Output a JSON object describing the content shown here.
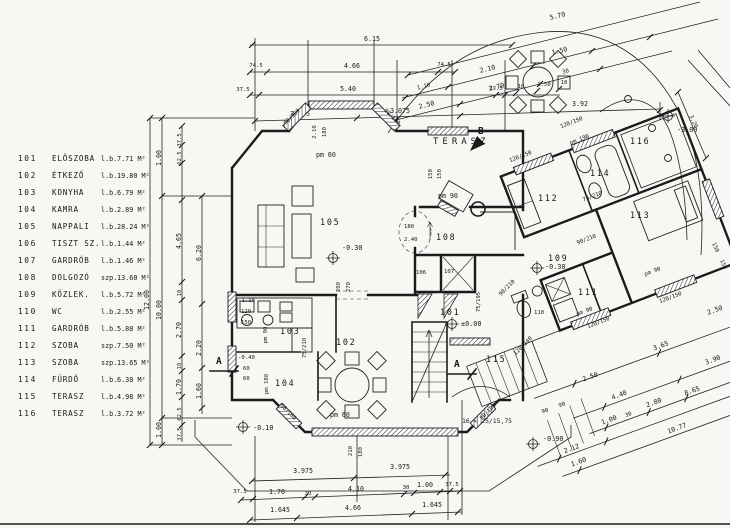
{
  "legend": {
    "rows": [
      {
        "n": "101",
        "m": "ELŐSZOBA",
        "t": "l.b.",
        "a": "7.71 M²"
      },
      {
        "n": "102",
        "m": "ÉTKEZŐ",
        "t": "l.b.",
        "a": "19.80 M²"
      },
      {
        "n": "103",
        "m": "KONYHA",
        "t": "l.b.",
        "a": "6.79 M²"
      },
      {
        "n": "104",
        "m": "KAMRA",
        "t": "l.b.",
        "a": "2.89 M²"
      },
      {
        "n": "105",
        "m": "NAPPALI",
        "t": "l.b.",
        "a": "28.24 M²"
      },
      {
        "n": "106",
        "m": "TISZT SZ.",
        "t": "l.b.",
        "a": "1.44 M²"
      },
      {
        "n": "107",
        "m": "GARDRÓB",
        "t": "l.b.",
        "a": "1.46 M²"
      },
      {
        "n": "108",
        "m": "DOLGOZÓ",
        "t": "szp.",
        "a": "13.60 M²"
      },
      {
        "n": "109",
        "m": "KÖZLEK.",
        "t": "l.b.",
        "a": "5.72 M²"
      },
      {
        "n": "110",
        "m": "WC",
        "t": "l.b.",
        "a": "2.55 M²"
      },
      {
        "n": "111",
        "m": "GARDRÓB",
        "t": "l.b.",
        "a": "5.88 M²"
      },
      {
        "n": "112",
        "m": "SZOBA",
        "t": "szp.",
        "a": "7.50 M²"
      },
      {
        "n": "113",
        "m": "SZOBA",
        "t": "szp.",
        "a": "13.65 M²"
      },
      {
        "n": "114",
        "m": "FÜRDŐ",
        "t": "l.b.",
        "a": "6.30 M²"
      },
      {
        "n": "115",
        "m": "TERASZ",
        "t": "l.b.",
        "a": "4.98 M²"
      },
      {
        "n": "116",
        "m": "TERASZ",
        "t": "l.b.",
        "a": "3.72 M²"
      }
    ]
  },
  "rooms": {
    "r101": "101",
    "r102": "102",
    "r103": "103",
    "r104": "104",
    "r105": "105",
    "r106": "106",
    "r107": "107",
    "r108": "108",
    "r109": "109",
    "r110": "110",
    "r111": "111",
    "r112": "112",
    "r113": "113",
    "r114": "114",
    "r115": "115",
    "r116": "116"
  },
  "levels": {
    "zero": "±0.00",
    "liv": "-0.30",
    "mid": "-0.30",
    "ent": "-0.10",
    "site": "-3.00",
    "grd": "-0.90",
    "wu": "-1.10",
    "wl": "-0.40"
  },
  "labels": {
    "terasz": "TERASZ",
    "a1": "A",
    "a2": "A",
    "b": "B",
    "stair": "16 × 25/15,75"
  },
  "dims": {
    "top1": "6.15",
    "top2a": "74.5",
    "top2b": "4.66",
    "top2c": "74.5",
    "top3a": "37.5",
    "top3b": "5.40",
    "top3c": "37.5",
    "top3d": "10",
    "top3e": "1.50",
    "top3f": "10",
    "top4a": "3.075",
    "top4b": "3.075",
    "top4c": "3.92",
    "dg1": "5.70",
    "dg2a": "1.10",
    "dg2b": "2.10",
    "dg2c": "1.50",
    "dg3a": "2.50",
    "dg3b": "2.70",
    "dg3c": "30",
    "r320": "3.20",
    "r150a": "150",
    "r150b": "150",
    "v0": "12.00",
    "v1a": "1.00",
    "v1b": "10.00",
    "v1c": "1.00",
    "v2a": "37.5",
    "v2b": "62.5",
    "v2c": "4.65",
    "v2d": "10",
    "v2e": "2.70",
    "v2f": "10",
    "v2g": "1.70",
    "v2h": "62.5",
    "v2i": "37.5",
    "v3a": "6.20",
    "v3b": "2.20",
    "v3c": "1.60",
    "b1a": "3.975",
    "b1b": "3.975",
    "b2a": "37.5",
    "b2b": "1.70",
    "b2c": "30",
    "b2d": "4.10",
    "b2e": "30",
    "b2f": "1.00",
    "b2g": "37.5",
    "b3a": "1.645",
    "b3b": "4.66",
    "b3c": "1.645",
    "q1a": "3.65",
    "q1b": "3.90",
    "q1c": "3.90",
    "q2a": "4.40",
    "q2b": "2.80",
    "q2c": "8.65",
    "q2d": "1.00",
    "q2e": "30",
    "q3a": "2.12",
    "q3b": "10.77",
    "q4a": "2.50",
    "q4b": "2.50",
    "q5a": "90",
    "q5b": "90",
    "q5c": "1.60",
    "wbay_pm": "pm 60",
    "wbay_a": "2.10",
    "wbay_b": "180",
    "wdiag1": "90/180",
    "wdiag2": "90/180",
    "wdiag3": "90/180",
    "wdiag4": "90/180",
    "wter_a": "150",
    "wter_b": "150",
    "wter_pm": "pm 90",
    "w112_pm": "pm 190",
    "w112_s": "120/150",
    "wB_s": "120/150",
    "w111_pm": "pm 90",
    "w111_s": "120/150",
    "w113_pm": "pm 90",
    "w113_s": "120/150",
    "o105a": "200",
    "o105b": "270",
    "oval_a": "180",
    "oval_b": "2.40",
    "wbb_pm": "pm 60",
    "wbb_a": "210",
    "wbb_b": "180",
    "d104": "75/210",
    "d104pm": "pm 180",
    "d114": "75/210",
    "d109": "90/210",
    "d101": "90/210",
    "d101w": "120/240",
    "wl_a": "120",
    "wl_b": "150",
    "wl_pm": "pm 90",
    "wl_c": "60",
    "wl_d": "60",
    "cl": "75/195"
  }
}
